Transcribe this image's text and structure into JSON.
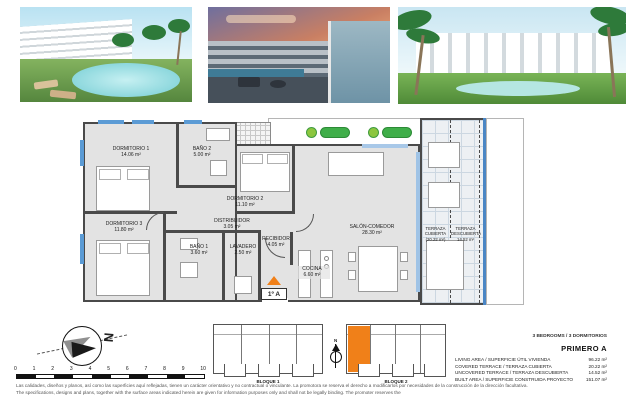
{
  "photos": [
    {
      "name": "render-pool-day",
      "desc": "apartment building with pool, daytime"
    },
    {
      "name": "render-terrace-dusk",
      "desc": "terrace view at sunset"
    },
    {
      "name": "render-building-garden",
      "desc": "apartment block with lawn and pool"
    }
  ],
  "plan": {
    "unit_door_label": "1º A",
    "rooms": {
      "dormitorio1": {
        "name": "DORMITORIO 1",
        "area": "14.06 m²"
      },
      "bano2": {
        "name": "BAÑO 2",
        "area": "5.00 m²"
      },
      "dormitorio2": {
        "name": "DORMITORIO 2",
        "area": "11.10 m²"
      },
      "dormitorio3": {
        "name": "DORMITORIO 3",
        "area": "11.80 m²"
      },
      "bano1": {
        "name": "BAÑO 1",
        "area": "3.60 m²"
      },
      "distribuidor": {
        "name": "DISTRIBUIDOR",
        "area": "3.05 m²"
      },
      "lavadero": {
        "name": "LAVADERO",
        "area": "2.50 m²"
      },
      "recibidor": {
        "name": "RECIBIDOR",
        "area": "4.05 m²"
      },
      "cocina": {
        "name": "COCINA",
        "area": "6.60 m²"
      },
      "salon": {
        "name": "SALÓN-COMEDOR",
        "area": "28.30 m²"
      },
      "terraza_cubierta": {
        "name": "TERRAZA CUBIERTA",
        "area": "(20.22 m²)"
      },
      "terraza_descubierta": {
        "name": "TERRAZA DESCUBIERTA",
        "area": "14.52 m²"
      }
    }
  },
  "compass": {
    "letter": "N"
  },
  "scalebar": {
    "ticks": [
      "0",
      "1",
      "2",
      "3",
      "4",
      "5",
      "6",
      "7",
      "8",
      "9",
      "10"
    ]
  },
  "keyplan": {
    "bloque1_label": "BLOQUE 1",
    "bloque2_label": "BLOQUE 2",
    "compass_letter": "N",
    "highlight_color": "#F08019"
  },
  "summary": {
    "type_line": "3 BEDROOMS / 3 DORMITORIOS",
    "unit_name": "PRIMERO A",
    "rows": [
      {
        "label": "LIVING AREA / SUPERFICIE ÚTIL VIVIENDA",
        "value": "96.22 m²"
      },
      {
        "label": "COVERED TERRACE / TERRAZA CUBIERTA",
        "value": "20.22 m²"
      },
      {
        "label": "UNCOVERED TERRACE / TERRAZA DESCUBIERTA",
        "value": "14.52 m²"
      },
      {
        "label": "BUILT AREA / SUPERFICIE CONSTRUIDA PROYECTO",
        "value": "151.07 m²"
      }
    ]
  },
  "disclaimer": {
    "es": "Las calidades, diseños y planos, así como las superficies aquí reflejadas, tienen un carácter orientativo y no contractual o vinculante. La promotora se reserva el derecho a modificarlos por necesidades de la construcción de la dirección facultativa.",
    "en": "The specifications, designs and plans, together with the surface areas indicated herein are given for information purposes only and shall not be legally binding. The promoter reserves the"
  },
  "colors": {
    "accent_orange": "#F08019",
    "plan_wall": "#4A4A4A",
    "glazing_blue": "#5B9BD5",
    "plant_green": "#3FAE49"
  }
}
